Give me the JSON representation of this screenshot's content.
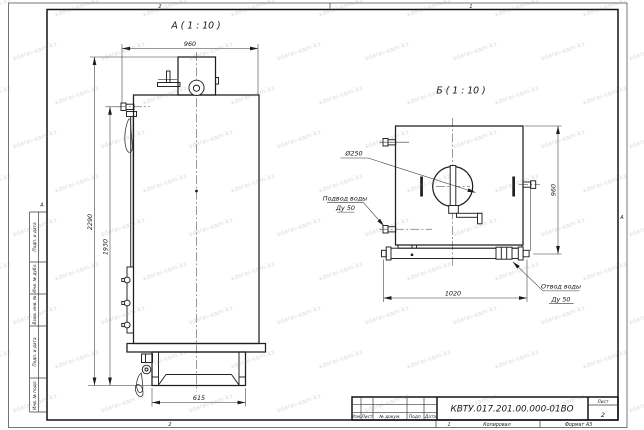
{
  "sheet": {
    "watermark": {
      "text": "sdelai-sam.kz"
    },
    "zones": {
      "top_2": "2",
      "top_1": "1",
      "bottom_2": "2",
      "bottom_1": "1",
      "left_a": "А",
      "right_a": "А"
    },
    "left_column": {
      "labels": [
        "Подп. и дата",
        "Инв. № дубл.",
        "Взам. инв. №",
        "Подп. и дата",
        "Инв. № подл."
      ]
    },
    "title_block": {
      "doc_number": "КВТУ.017.201.00.000-01ВО",
      "col_izm": "Изм.",
      "col_list": "Лист",
      "col_doc": "№ докум.",
      "col_podp": "Подп.",
      "col_data": "Дата",
      "sheet_label": "Лист",
      "sheet_number": "2",
      "copied": "Копировал",
      "format": "Формат А3"
    }
  },
  "views": {
    "front": {
      "title": "А ( 1 : 10 )",
      "dim_width": "960",
      "dim_height_total": "2290",
      "dim_height_pipe": "1930",
      "dim_base": "615"
    },
    "top": {
      "title": "Б ( 1 : 10 )",
      "dim_depth": "960",
      "dim_overall": "1020",
      "label_diameter": "Ø250",
      "inlet_line1": "Подвод воды",
      "inlet_line2": "Ду 50",
      "outlet_line1": "Отвод воды",
      "outlet_line2": "Ду 50"
    }
  }
}
